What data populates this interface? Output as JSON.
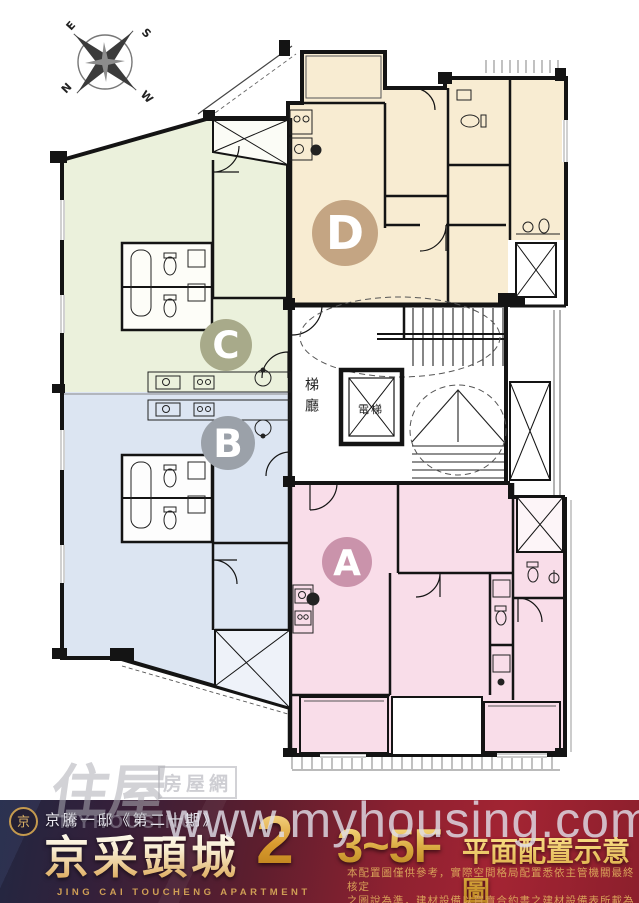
{
  "compass": {
    "e": "E",
    "s": "S",
    "n": "N",
    "w": "W"
  },
  "plan": {
    "units": [
      {
        "letter": "A",
        "fill": "#f9dde9",
        "badge": "#ca93ab"
      },
      {
        "letter": "B",
        "fill": "#dce5f2",
        "badge": "#9ba1a9"
      },
      {
        "letter": "C",
        "fill": "#ebf1dc",
        "badge": "#a8aa8a"
      },
      {
        "letter": "D",
        "fill": "#f8ecd2",
        "badge": "#c4a583"
      }
    ],
    "labels": {
      "stair_hall": "梯廳",
      "elevator": "電梯"
    }
  },
  "watermarks": {
    "site": "www.myhousing.com.tw",
    "logo_main": "住屋",
    "logo_sub": "房屋網",
    "logo_en": "MYHOUSING"
  },
  "banner": {
    "logo_char": "京",
    "series": "京騰一邸《第二十期》",
    "title": "京采頭城",
    "title_num": "2",
    "subtitle_en": "JING CAI TOUCHENG APARTMENT",
    "floor_label": "3~5F",
    "plan_label": "平面配置示意圖",
    "disclaimer_line1": "本配置圖僅供參考，實際空間格局配置悉依主管機關最終核定",
    "disclaimer_line2": "之圖說為準，建材設備以買賣合約書之建材設備表所載為準。"
  }
}
